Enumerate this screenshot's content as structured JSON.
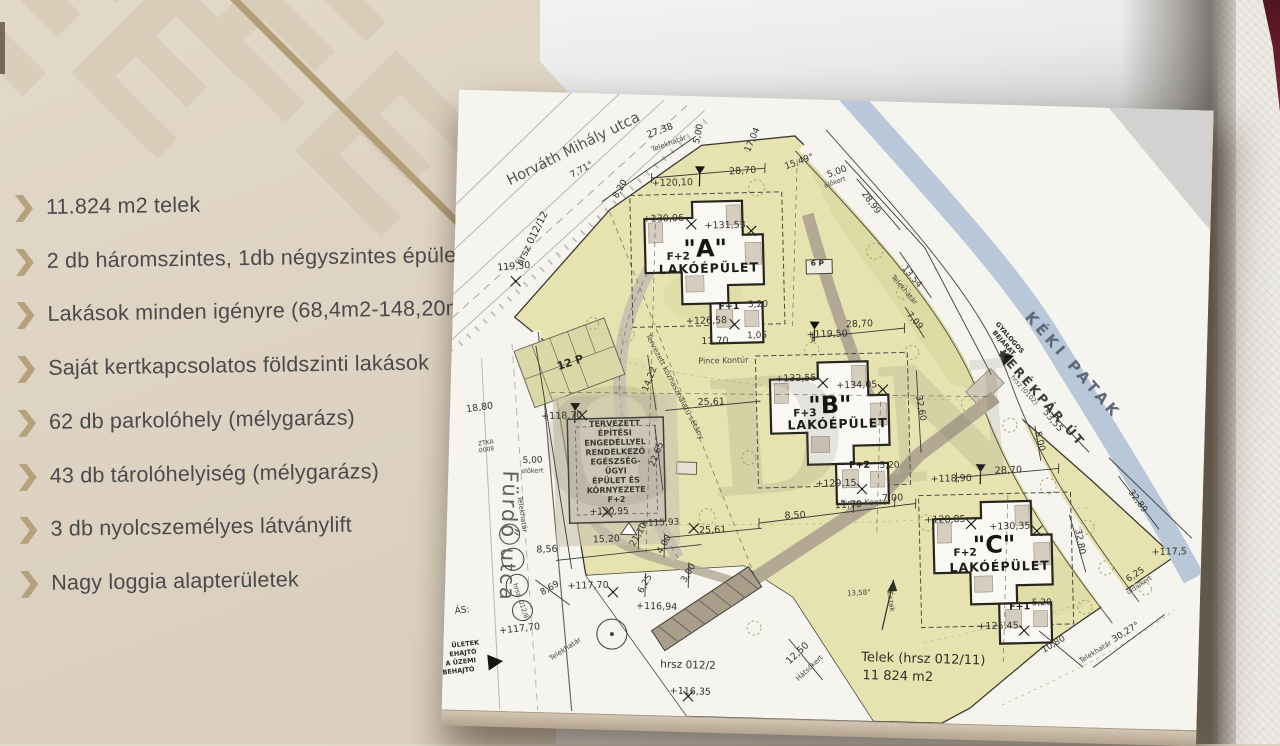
{
  "slide": {
    "colors": {
      "background": "#ddd2c1",
      "accent": "#b5a17c",
      "text": "#4a4a4d",
      "logo_pattern": "#d3c6b0",
      "diagonal_line": "#b29d77"
    },
    "bullet_icon": "chevron-right",
    "bullets": [
      "11.824 m2 telek",
      "2 db háromszintes, 1db négyszintes épület",
      "Lakások minden igényre (68,4m2-148,20m2)",
      "Saját kertkapcsolatos földszinti lakások",
      "62 db parkolóhely (mélygarázs)",
      "43 db tárolóhelyiség (mélygarázs)",
      "3 db nyolcszemélyes látványlift",
      "Nagy loggia alapterületek"
    ]
  },
  "plan": {
    "watermark_text": "GDN",
    "colors": {
      "page": "#f6f4ef",
      "parcel": "#e6e3b0",
      "parcel_dark": "#d9d7a0",
      "stream": "#b9c8d8",
      "road": "#b2a893",
      "building": "#faf8f3",
      "outline": "#26261f"
    },
    "labels": [
      {
        "t": "Horváth Mihály utca",
        "x": 118,
        "y": 60,
        "r": -28,
        "s": 14.5,
        "c": "street"
      },
      {
        "t": "hrsz 012/12",
        "x": 80,
        "y": 148,
        "r": -65,
        "s": 10,
        "c": "dim"
      },
      {
        "t": "Fürdő utca",
        "x": 55,
        "y": 445,
        "r": 90,
        "s": 21,
        "c": "street2"
      },
      {
        "t": "KÉKI PATAK",
        "x": 618,
        "y": 262,
        "r": 47,
        "s": 15,
        "c": "water"
      },
      {
        "t": "KERÉKPÁR ÚT",
        "x": 588,
        "y": 295,
        "r": 47,
        "s": 12.5,
        "c": "kerek"
      },
      {
        "lines": [
          "GYALOGOS",
          "BEJÁRAT"
        ],
        "lh": 8,
        "x": 556,
        "y": 234,
        "r": 47,
        "s": 6.5,
        "c": "tinyb"
      },
      {
        "t": "hrsz (0102)",
        "x": 572,
        "y": 286,
        "r": 47,
        "s": 6.5,
        "c": "tiny"
      },
      {
        "t": "Tervezett közhasználatú sétány",
        "x": 222,
        "y": 292,
        "r": 61,
        "s": 7.5,
        "c": "tiny"
      },
      {
        "t": "Pince Kontúr",
        "x": 272,
        "y": 266,
        "r": -3,
        "s": 8,
        "c": "tiny"
      },
      {
        "t": "Pince Kontúr",
        "x": 418,
        "y": 404,
        "r": -3,
        "s": 8,
        "c": "tiny"
      },
      {
        "t": "12 P",
        "x": 120,
        "y": 273,
        "r": -20,
        "s": 11,
        "c": "dimb"
      },
      {
        "t": "6 P",
        "x": 363,
        "y": 166,
        "r": 0,
        "s": 7.5,
        "c": "dimb"
      },
      {
        "lines": [
          "TERVEZETT",
          "ÉPÍTÉSI",
          "ENGEDÉLLYEL",
          "RENDELKEZŐ",
          "EGÉSZSÉG-",
          "ÜGYI",
          "ÉPÜLET ÉS",
          "KÖRNYEZETE",
          "F+2"
        ],
        "lh": 9.5,
        "x": 165,
        "y": 332,
        "r": -3,
        "s": 8,
        "c": "tinyc"
      },
      {
        "t": "+130,95",
        "x": 162,
        "y": 420,
        "r": -3,
        "s": 9,
        "c": "dim"
      },
      {
        "t": "+118,70",
        "x": 112,
        "y": 326,
        "r": -3,
        "s": 9.5,
        "c": "dim"
      },
      {
        "t": "18,80",
        "x": 30,
        "y": 320,
        "r": -10,
        "s": 9.5,
        "c": "dim"
      },
      {
        "t": "119,30",
        "x": 60,
        "y": 178,
        "r": -6,
        "s": 9.5,
        "c": "dim"
      },
      {
        "t": "5,00",
        "x": 84,
        "y": 371,
        "r": -3,
        "s": 9,
        "c": "dim"
      },
      {
        "t": "előkert",
        "x": 84,
        "y": 381,
        "r": -3,
        "s": 6.5,
        "c": "tiny"
      },
      {
        "t": "ZTKA",
        "x": 37,
        "y": 354,
        "r": -10,
        "s": 6,
        "c": "tiny"
      },
      {
        "t": ".0008",
        "x": 37,
        "y": 361,
        "r": -10,
        "s": 6,
        "c": "tiny"
      },
      {
        "t": "27,38",
        "x": 203,
        "y": 38,
        "r": -22,
        "s": 9.5,
        "c": "dim"
      },
      {
        "t": "Telekhatár",
        "x": 212,
        "y": 50,
        "r": -22,
        "s": 7,
        "c": "tiny"
      },
      {
        "t": "7,71°",
        "x": 126,
        "y": 79,
        "r": -30,
        "s": 9,
        "c": "dim"
      },
      {
        "t": "8,20",
        "x": 166,
        "y": 96,
        "r": -62,
        "s": 9,
        "c": "dim"
      },
      {
        "t": "5,00",
        "x": 243,
        "y": 38,
        "r": -80,
        "s": 9,
        "c": "dim"
      },
      {
        "t": "17,04",
        "x": 297,
        "y": 43,
        "r": -68,
        "s": 9,
        "c": "dim"
      },
      {
        "t": "+120,10",
        "x": 216,
        "y": 90,
        "r": -3,
        "s": 9.5,
        "c": "dim"
      },
      {
        "t": "28,70",
        "x": 286,
        "y": 76,
        "r": -5,
        "s": 9.5,
        "c": "dim"
      },
      {
        "t": "15,49°",
        "x": 343,
        "y": 65,
        "r": -22,
        "s": 9,
        "c": "dim"
      },
      {
        "t": "5,00",
        "x": 381,
        "y": 74,
        "r": -22,
        "s": 9,
        "c": "dim"
      },
      {
        "t": "előkert",
        "x": 379,
        "y": 84,
        "r": -22,
        "s": 6.5,
        "c": "tiny"
      },
      {
        "t": "28,99",
        "x": 413,
        "y": 103,
        "r": 52,
        "s": 9,
        "c": "dim"
      },
      {
        "t": "13,54",
        "x": 456,
        "y": 176,
        "r": 48,
        "s": 9,
        "c": "dim"
      },
      {
        "t": "Telekhatár",
        "x": 449,
        "y": 189,
        "r": 48,
        "s": 7,
        "c": "tiny"
      },
      {
        "t": "7,09",
        "x": 460,
        "y": 220,
        "r": 48,
        "s": 9,
        "c": "dim"
      },
      {
        "t": "+130,06",
        "x": 208,
        "y": 126,
        "r": -3,
        "s": 9.5,
        "c": "dim"
      },
      {
        "t": "+131,53",
        "x": 270,
        "y": 131,
        "r": -3,
        "s": 9.5,
        "c": "dim"
      },
      {
        "t": "\"A\"",
        "x": 251,
        "y": 160,
        "r": -3,
        "s": 24,
        "c": "bname"
      },
      {
        "t": "F+2",
        "x": 224,
        "y": 164,
        "r": -3,
        "s": 10.5,
        "c": "bsub"
      },
      {
        "t": "LAKÓÉPÜLET",
        "x": 255,
        "y": 176,
        "r": -3,
        "s": 12.5,
        "c": "blako"
      },
      {
        "t": "F+1",
        "x": 276,
        "y": 212,
        "r": -3,
        "s": 9.5,
        "c": "bsub"
      },
      {
        "t": "+126,58",
        "x": 254,
        "y": 227,
        "r": -3,
        "s": 9.5,
        "c": "dim"
      },
      {
        "t": "5,20",
        "x": 305,
        "y": 209,
        "r": -3,
        "s": 9,
        "c": "dim"
      },
      {
        "t": "11,70",
        "x": 263,
        "y": 247,
        "r": -3,
        "s": 9.5,
        "c": "dim"
      },
      {
        "t": "1,05",
        "x": 305,
        "y": 240,
        "r": -3,
        "s": 9,
        "c": "dim"
      },
      {
        "t": "+119,50",
        "x": 375,
        "y": 237,
        "r": -3,
        "s": 9.5,
        "c": "dim"
      },
      {
        "t": "28,70",
        "x": 407,
        "y": 226,
        "r": -4,
        "s": 9.5,
        "c": "dim"
      },
      {
        "t": "+132,55",
        "x": 345,
        "y": 282,
        "r": -3,
        "s": 9.5,
        "c": "dim"
      },
      {
        "t": "+134,05",
        "x": 406,
        "y": 287,
        "r": -3,
        "s": 9.5,
        "c": "dim"
      },
      {
        "t": "\"B\"",
        "x": 380,
        "y": 313,
        "r": -3,
        "s": 24,
        "c": "bname"
      },
      {
        "t": "F+3",
        "x": 355,
        "y": 317,
        "r": -3,
        "s": 10.5,
        "c": "bsub"
      },
      {
        "t": "LAKÓÉPÜLET",
        "x": 388,
        "y": 328,
        "r": -3,
        "s": 12.5,
        "c": "blako"
      },
      {
        "t": "F+2",
        "x": 411,
        "y": 367,
        "r": -3,
        "s": 9.5,
        "c": "bsub"
      },
      {
        "t": "5,20",
        "x": 441,
        "y": 366,
        "r": -3,
        "s": 9,
        "c": "dim"
      },
      {
        "t": "+129,15",
        "x": 388,
        "y": 386,
        "r": -3,
        "s": 9.5,
        "c": "dim"
      },
      {
        "t": "32,60",
        "x": 468,
        "y": 306,
        "r": 78,
        "s": 9,
        "c": "dim"
      },
      {
        "t": "8,50",
        "x": 348,
        "y": 419,
        "r": -4,
        "s": 9.5,
        "c": "dim"
      },
      {
        "t": "11,70",
        "x": 401,
        "y": 407,
        "r": -4,
        "s": 9.5,
        "c": "dim"
      },
      {
        "t": "7,00",
        "x": 445,
        "y": 399,
        "r": -4,
        "s": 9.5,
        "c": "dim"
      },
      {
        "t": "+118,90",
        "x": 503,
        "y": 378,
        "r": -3,
        "s": 9.5,
        "c": "dim"
      },
      {
        "t": "28,70",
        "x": 560,
        "y": 368,
        "r": -4,
        "s": 9.5,
        "c": "dim"
      },
      {
        "t": "5,00",
        "x": 588,
        "y": 336,
        "r": 75,
        "s": 9,
        "c": "dim"
      },
      {
        "t": "53,55",
        "x": 601,
        "y": 316,
        "r": 48,
        "s": 9,
        "c": "dim"
      },
      {
        "t": "+128,85",
        "x": 498,
        "y": 419,
        "r": -3,
        "s": 9.5,
        "c": "dim"
      },
      {
        "t": "+130,35",
        "x": 563,
        "y": 424,
        "r": -3,
        "s": 9.5,
        "c": "dim"
      },
      {
        "t": "\"C\"",
        "x": 548,
        "y": 448,
        "r": -3,
        "s": 24,
        "c": "bname"
      },
      {
        "t": "F+2",
        "x": 519,
        "y": 452,
        "r": -3,
        "s": 10.5,
        "c": "bsub"
      },
      {
        "t": "LAKÓÉPÜLET",
        "x": 554,
        "y": 466,
        "r": -3,
        "s": 12.5,
        "c": "blako"
      },
      {
        "t": "F+1",
        "x": 575,
        "y": 504,
        "r": -3,
        "s": 9.5,
        "c": "bsub"
      },
      {
        "t": "+125,45",
        "x": 554,
        "y": 524,
        "r": -3,
        "s": 9.5,
        "c": "dim"
      },
      {
        "t": "5,20",
        "x": 597,
        "y": 499,
        "r": -3,
        "s": 9,
        "c": "dim"
      },
      {
        "t": "10,80",
        "x": 611,
        "y": 540,
        "r": -32,
        "s": 9,
        "c": "dim"
      },
      {
        "t": "6,25",
        "x": 691,
        "y": 468,
        "r": -35,
        "s": 9,
        "c": "dim"
      },
      {
        "t": "oldalkert",
        "x": 695,
        "y": 478,
        "r": -35,
        "s": 6.5,
        "c": "tiny"
      },
      {
        "t": "+117,5",
        "x": 723,
        "y": 445,
        "r": -3,
        "s": 9.5,
        "c": "dim"
      },
      {
        "t": "32,89",
        "x": 688,
        "y": 394,
        "r": 52,
        "s": 9,
        "c": "dim"
      },
      {
        "t": "32,80",
        "x": 631,
        "y": 435,
        "r": 78,
        "s": 9,
        "c": "dim"
      },
      {
        "t": "30,27°",
        "x": 683,
        "y": 526,
        "r": -33,
        "s": 9,
        "c": "dim"
      },
      {
        "t": "Telekhatár",
        "x": 653,
        "y": 546,
        "r": -33,
        "s": 7,
        "c": "tiny"
      },
      {
        "t": "25,61",
        "x": 261,
        "y": 308,
        "r": -3,
        "s": 9.5,
        "c": "dim"
      },
      {
        "t": "25,61",
        "x": 266,
        "y": 436,
        "r": -3,
        "s": 9.5,
        "c": "dim"
      },
      {
        "t": "22,65",
        "x": 210,
        "y": 360,
        "r": -70,
        "s": 9,
        "c": "dim"
      },
      {
        "t": "14,22",
        "x": 201,
        "y": 285,
        "r": -70,
        "s": 9,
        "c": "dim"
      },
      {
        "t": "15,20",
        "x": 160,
        "y": 448,
        "r": -4,
        "s": 9.5,
        "c": "dim"
      },
      {
        "t": "21,10",
        "x": 194,
        "y": 441,
        "r": -62,
        "s": 9,
        "c": "dim"
      },
      {
        "t": "8,56",
        "x": 101,
        "y": 460,
        "r": -4,
        "s": 9.5,
        "c": "dim"
      },
      {
        "t": "4,00",
        "x": 220,
        "y": 450,
        "r": -62,
        "s": 9,
        "c": "dim"
      },
      {
        "t": "+115,93",
        "x": 213,
        "y": 430,
        "r": -4,
        "s": 9,
        "c": "dim"
      },
      {
        "t": "3,00",
        "x": 245,
        "y": 478,
        "r": -62,
        "s": 9,
        "c": "dim"
      },
      {
        "t": "6,25",
        "x": 202,
        "y": 490,
        "r": -62,
        "s": 9,
        "c": "dim"
      },
      {
        "t": "8,69",
        "x": 106,
        "y": 498,
        "r": -32,
        "s": 9,
        "c": "dim"
      },
      {
        "t": "+117,70",
        "x": 143,
        "y": 495,
        "r": -3,
        "s": 9.5,
        "c": "dim"
      },
      {
        "t": "+117,70",
        "x": 76,
        "y": 540,
        "r": -8,
        "s": 9.5,
        "c": "dim"
      },
      {
        "t": "Telekhatár",
        "x": 73,
        "y": 423,
        "r": 80,
        "s": 7,
        "c": "tiny"
      },
      {
        "t": "Telekhatár",
        "x": 123,
        "y": 558,
        "r": -35,
        "s": 7,
        "c": "tiny"
      },
      {
        "t": "12,50",
        "x": 356,
        "y": 556,
        "r": -45,
        "s": 9.5,
        "c": "dim"
      },
      {
        "t": "Hátsókert",
        "x": 368,
        "y": 570,
        "r": -45,
        "s": 7,
        "c": "tiny"
      },
      {
        "t": "hrsz 012/2",
        "x": 245,
        "y": 572,
        "r": 0,
        "s": 10.5,
        "c": "dim"
      },
      {
        "t": "+116,94",
        "x": 212,
        "y": 514,
        "r": 0,
        "s": 9.5,
        "c": "dim"
      },
      {
        "t": "+116,35",
        "x": 248,
        "y": 598,
        "r": 0,
        "s": 9.5,
        "c": "dim"
      },
      {
        "t": "Telek (hrsz 012/11)",
        "x": 480,
        "y": 560,
        "r": 0,
        "s": 13,
        "c": "telek"
      },
      {
        "t": "11 824 m2",
        "x": 455,
        "y": 578,
        "r": 0,
        "s": 13,
        "c": "telek"
      },
      {
        "t": "13,58°",
        "x": 414,
        "y": 494,
        "r": -5,
        "s": 7,
        "c": "tiny"
      },
      {
        "t": "Észak",
        "x": 444,
        "y": 500,
        "r": 80,
        "s": 7,
        "c": "tiny"
      },
      {
        "t": "ÁS:",
        "x": 18,
        "y": 523,
        "r": -8,
        "s": 9,
        "c": "dim"
      },
      {
        "t": "ÜLETEK",
        "x": 22,
        "y": 556,
        "r": -8,
        "s": 6.5,
        "c": "tinyb"
      },
      {
        "t": "EHAJTÓ",
        "x": 20,
        "y": 565,
        "r": -8,
        "s": 6.5,
        "c": "tinyb"
      },
      {
        "t": "A ÜZEMI",
        "x": 18,
        "y": 574,
        "r": -8,
        "s": 6.5,
        "c": "tinyb"
      },
      {
        "t": "BEHAJTÓ",
        "x": 16,
        "y": 583,
        "r": -8,
        "s": 6.5,
        "c": "tinyb"
      },
      {
        "t": "hrsz. 012/8",
        "x": 74,
        "y": 510,
        "r": 70,
        "s": 6.5,
        "c": "tiny"
      }
    ]
  }
}
